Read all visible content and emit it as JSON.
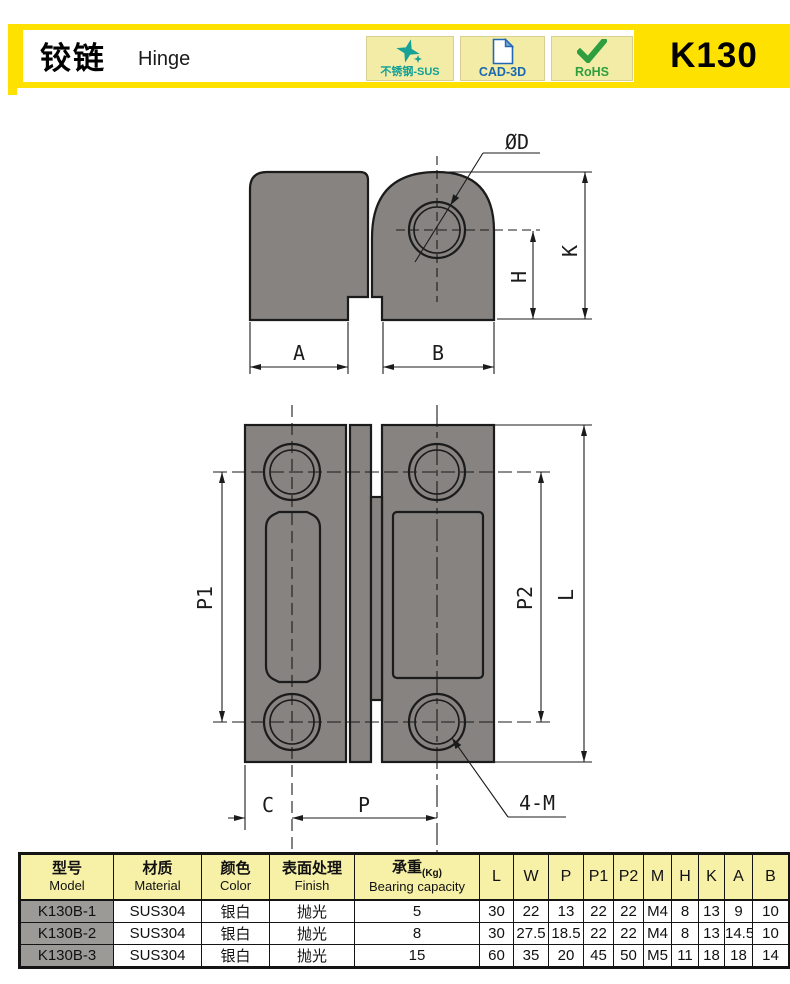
{
  "header": {
    "title_cn": "铰链",
    "title_en": "Hinge",
    "model_code": "K130",
    "badges": [
      {
        "label": "不锈钢-SUS",
        "icon": "sparkle-star-icon",
        "color": "#12a097"
      },
      {
        "label": "CAD-3D",
        "icon": "document-icon",
        "color": "#1a68b2"
      },
      {
        "label": "RoHS",
        "icon": "checkmark-icon",
        "color": "#2f9e3f"
      }
    ]
  },
  "colors": {
    "accent_yellow": "#ffe100",
    "part_gray": "#868381",
    "table_header_bg": "#f7f1a8",
    "model_cell_bg": "#9c9a97"
  },
  "drawings": {
    "side_view": {
      "labels": {
        "dia": "ØD",
        "k": "K",
        "h": "H",
        "a": "A",
        "b": "B"
      }
    },
    "front_view": {
      "labels": {
        "p1": "P1",
        "p2": "P2",
        "l": "L",
        "c": "C",
        "p": "P",
        "thread": "4-M"
      }
    }
  },
  "table": {
    "headers": [
      {
        "cn": "型号",
        "en": "Model"
      },
      {
        "cn": "材质",
        "en": "Material"
      },
      {
        "cn": "颜色",
        "en": "Color"
      },
      {
        "cn": "表面处理",
        "en": "Finish"
      },
      {
        "cn": "承重",
        "unit": "(Kg)",
        "en": "Bearing capacity"
      }
    ],
    "dim_headers": [
      "L",
      "W",
      "P",
      "P1",
      "P2",
      "M",
      "H",
      "K",
      "A",
      "B"
    ],
    "rows": [
      {
        "model": "K130B-1",
        "material": "SUS304",
        "color": "银白",
        "finish": "抛光",
        "capacity": "5",
        "dims": [
          "30",
          "22",
          "13",
          "22",
          "22",
          "M4",
          "8",
          "13",
          "9",
          "10"
        ]
      },
      {
        "model": "K130B-2",
        "material": "SUS304",
        "color": "银白",
        "finish": "抛光",
        "capacity": "8",
        "dims": [
          "30",
          "27.5",
          "18.5",
          "22",
          "22",
          "M4",
          "8",
          "13",
          "14.5",
          "10"
        ]
      },
      {
        "model": "K130B-3",
        "material": "SUS304",
        "color": "银白",
        "finish": "抛光",
        "capacity": "15",
        "dims": [
          "60",
          "35",
          "20",
          "45",
          "50",
          "M5",
          "11",
          "18",
          "18",
          "14"
        ]
      }
    ]
  }
}
